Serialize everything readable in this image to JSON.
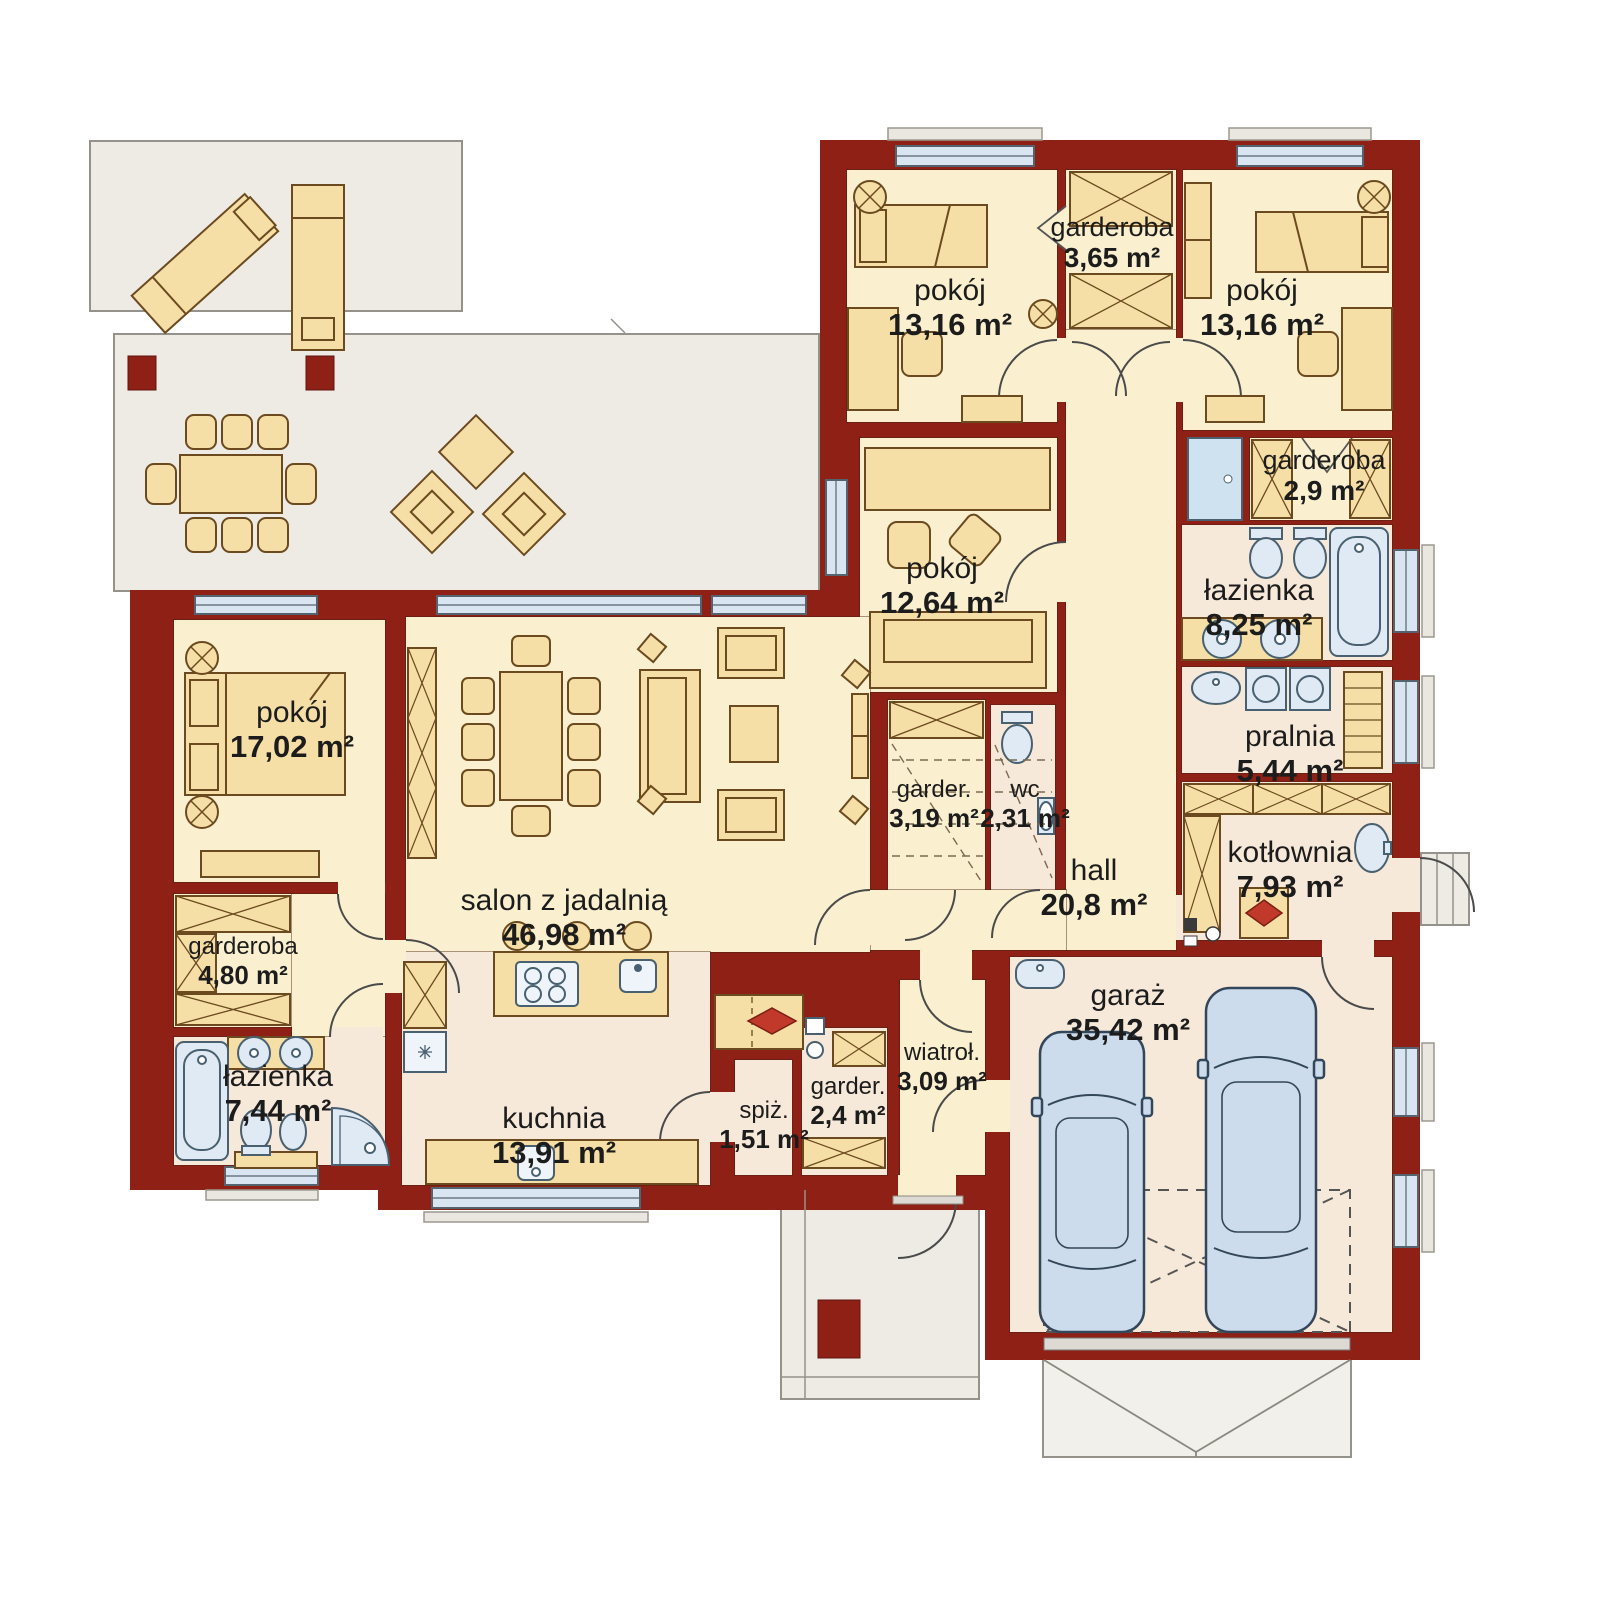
{
  "palette": {
    "wall": "#8e2016",
    "room_floor": "#faf0d0",
    "service_floor": "#f7e9da",
    "furniture": "#f6dfa6",
    "furniture_stroke": "#6b4a1f",
    "terrace": "#edebe4",
    "window_glass": "#d9e6f1",
    "fixture_blue": "#dfeaf4",
    "car_blue": "#ccdcec",
    "flame_red": "#c0392b",
    "label_text": "#1c1c1c"
  },
  "rooms": {
    "pokoj_13a": {
      "name": "pokój",
      "area": "13,16 m²"
    },
    "garderoba_365": {
      "name": "garderoba",
      "area": "3,65 m²"
    },
    "pokoj_13b": {
      "name": "pokój",
      "area": "13,16 m²"
    },
    "garderoba_29": {
      "name": "garderoba",
      "area": "2,9 m²"
    },
    "pokoj_1264": {
      "name": "pokój",
      "area": "12,64 m²"
    },
    "lazienka_825": {
      "name": "łazienka",
      "area": "8,25 m²"
    },
    "pralnia": {
      "name": "pralnia",
      "area": "5,44 m²"
    },
    "kotlownia": {
      "name": "kotłownia",
      "area": "7,93 m²"
    },
    "hall": {
      "name": "hall",
      "area": "20,8 m²"
    },
    "garderoba_319": {
      "name": "garder.",
      "area": "3,19 m²"
    },
    "wc": {
      "name": "wc",
      "area": "2,31 m²"
    },
    "pokoj_17": {
      "name": "pokój",
      "area": "17,02 m²"
    },
    "garderoba_480": {
      "name": "garderoba",
      "area": "4,80 m²"
    },
    "lazienka_744": {
      "name": "łazienka",
      "area": "7,44 m²"
    },
    "salon": {
      "name": "salon z jadalnią",
      "area": "46,98 m²"
    },
    "kuchnia": {
      "name": "kuchnia",
      "area": "13,91 m²"
    },
    "spiz": {
      "name": "spiż.",
      "area": "1,51 m²"
    },
    "garderoba_24": {
      "name": "garder.",
      "area": "2,4 m²"
    },
    "wiatrolap": {
      "name": "wiatroł.",
      "area": "3,09 m²"
    },
    "garaz": {
      "name": "garaż",
      "area": "35,42 m²"
    }
  }
}
